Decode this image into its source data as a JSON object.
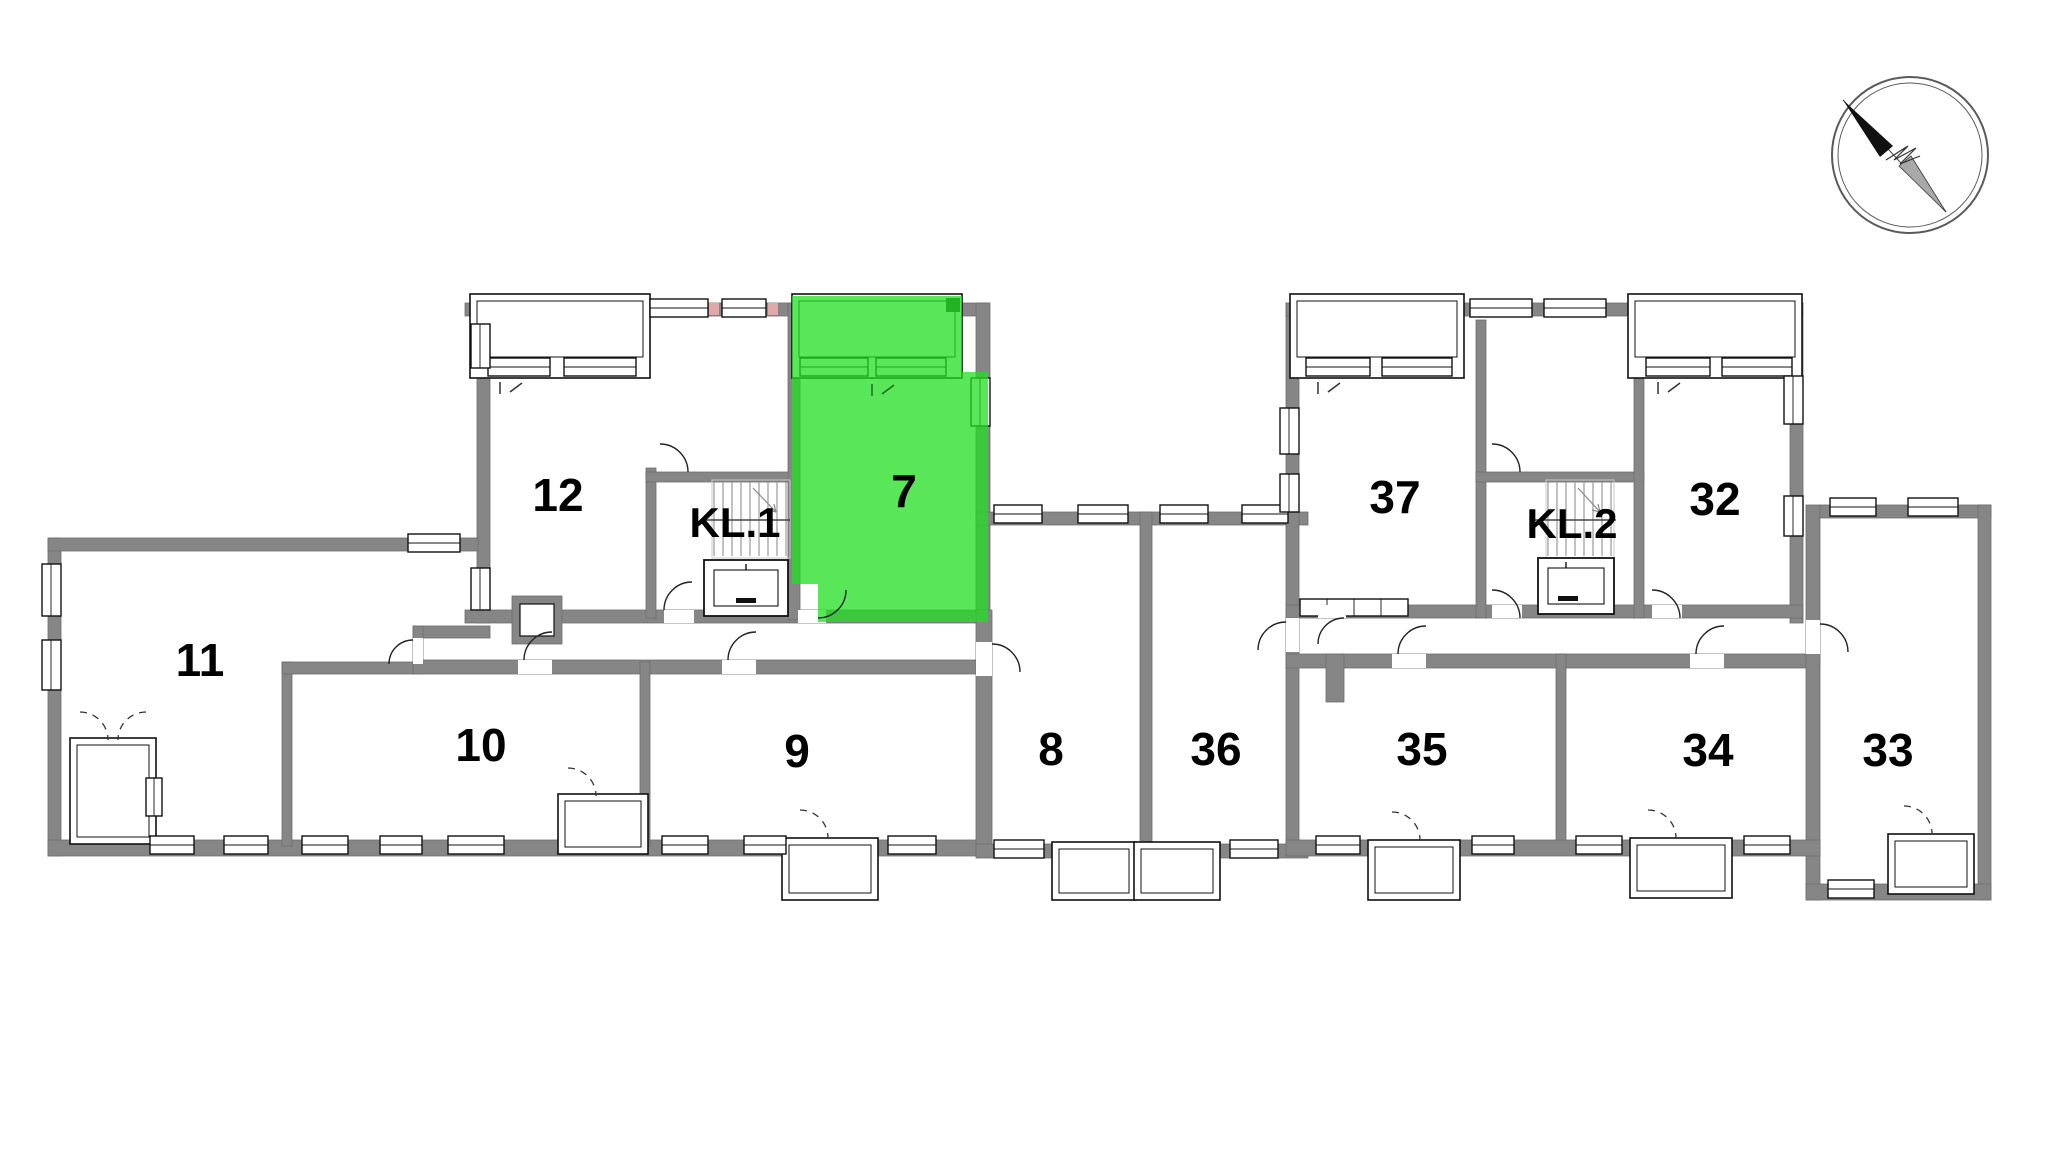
{
  "page": {
    "background": "#ffffff"
  },
  "highlight": {
    "unit": "7",
    "fill": "rgba(34,221,34,0.75)",
    "label_color": "#1f9e1f",
    "corner_block_color": "#21b321"
  },
  "colors": {
    "wall": "#868686",
    "outline": "#111111",
    "accent_pink": "#dfa9a9",
    "label": "#000000",
    "stair_tread": "#9a9a9a",
    "compass_ring": "#5a5a5a"
  },
  "compass": {
    "icon": "north-arrow",
    "direction": "northwest"
  },
  "units": [
    {
      "id": "12",
      "label": "12",
      "type": "apartment",
      "highlighted": false
    },
    {
      "id": "KL.1",
      "label": "KL.1",
      "type": "stairwell",
      "highlighted": false
    },
    {
      "id": "7",
      "label": "7",
      "type": "apartment",
      "highlighted": true
    },
    {
      "id": "11",
      "label": "11",
      "type": "apartment",
      "highlighted": false
    },
    {
      "id": "10",
      "label": "10",
      "type": "apartment",
      "highlighted": false
    },
    {
      "id": "9",
      "label": "9",
      "type": "apartment",
      "highlighted": false
    },
    {
      "id": "8",
      "label": "8",
      "type": "apartment",
      "highlighted": false
    },
    {
      "id": "36",
      "label": "36",
      "type": "apartment",
      "highlighted": false
    },
    {
      "id": "37",
      "label": "37",
      "type": "apartment",
      "highlighted": false
    },
    {
      "id": "KL.2",
      "label": "KL.2",
      "type": "stairwell",
      "highlighted": false
    },
    {
      "id": "32",
      "label": "32",
      "type": "apartment",
      "highlighted": false
    },
    {
      "id": "35",
      "label": "35",
      "type": "apartment",
      "highlighted": false
    },
    {
      "id": "34",
      "label": "34",
      "type": "apartment",
      "highlighted": false
    },
    {
      "id": "33",
      "label": "33",
      "type": "apartment",
      "highlighted": false
    }
  ]
}
